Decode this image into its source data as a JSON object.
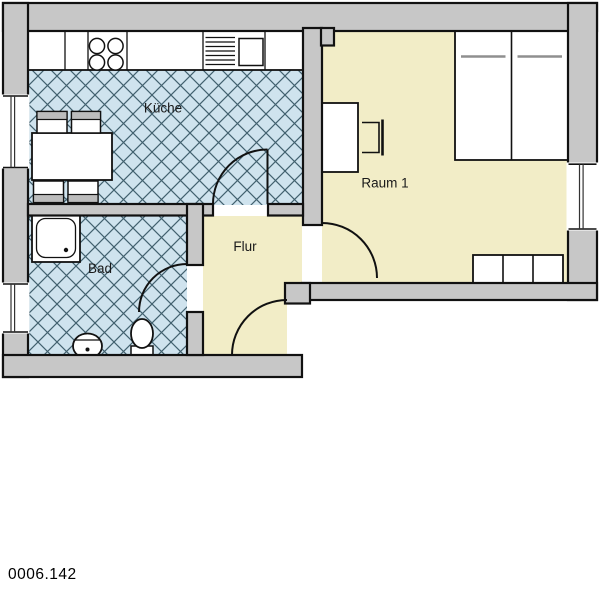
{
  "plan": {
    "plan_number": "0006.142",
    "rooms": {
      "kitchen": {
        "label": "Küche"
      },
      "bath": {
        "label": "Bad"
      },
      "hall": {
        "label": "Flur"
      },
      "room1": {
        "label": "Raum 1"
      }
    },
    "colors": {
      "wall_fill": "#c7c7c7",
      "tile_room_fill": "#cfe3ee",
      "living_room_fill": "#f2edc7",
      "hatch_line": "#42616f",
      "outline": "#111111",
      "label_text": "#1a1a1a"
    },
    "fixtures": {
      "kitchen": [
        "counter",
        "stove",
        "sink",
        "dining-table",
        "chairs"
      ],
      "bath": [
        "shower",
        "washbasin",
        "toilet"
      ],
      "room1": [
        "double-bed",
        "desk",
        "desk-chair",
        "cabinet"
      ],
      "openings": [
        "entry-door",
        "kitchen-door",
        "bath-door",
        "room1-door",
        "window-kitchen",
        "window-bath",
        "window-room1"
      ]
    }
  }
}
